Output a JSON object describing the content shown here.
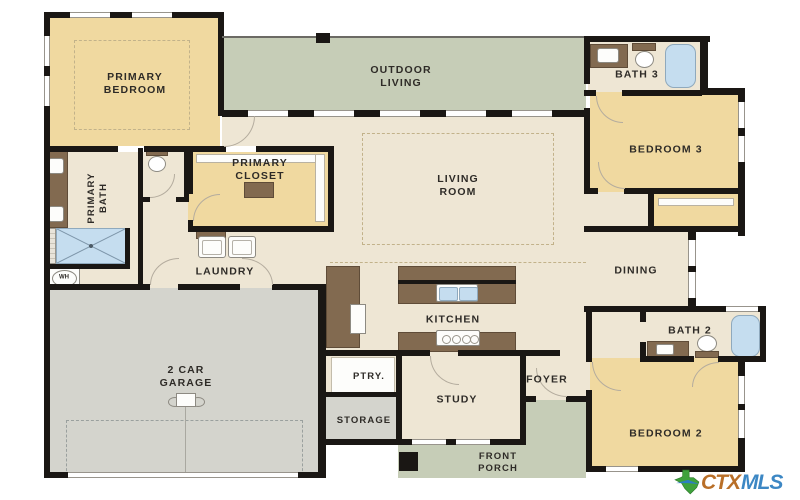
{
  "floor_plan": {
    "rooms": {
      "primary_bedroom": "PRIMARY BEDROOM",
      "outdoor_living": "OUTDOOR LIVING",
      "bath_3": "BATH 3",
      "bedroom_3": "BEDROOM 3",
      "primary_bath": "PRIMARY BATH",
      "primary_closet": "PRIMARY CLOSET",
      "living_room": "LIVING ROOM",
      "laundry": "LAUNDRY",
      "dining": "DINING",
      "garage": "2 CAR GARAGE",
      "kitchen": "KITCHEN",
      "pantry": "PTRY.",
      "storage": "STORAGE",
      "study": "STUDY",
      "foyer": "FOYER",
      "bath_2": "BATH 2",
      "bedroom_2": "BEDROOM 2",
      "front_porch": "FRONT PORCH"
    },
    "fixtures": {
      "water_heater": "WH"
    },
    "branding": {
      "mark": "CTX",
      "suffix": "MLS"
    },
    "colors": {
      "floor_beige": "#EEE6D4",
      "bedroom_yellow": "#F0D9A0",
      "outdoor_green": "#C6CDB7",
      "garage_gray": "#D4D4CD",
      "wall_black": "#1A1714",
      "cabinet_brown": "#826A50",
      "fixture_blue": "#C5DDEF",
      "logo_orange": "#B96F28",
      "logo_blue": "#3C87C4",
      "logo_green": "#3FA23C"
    }
  }
}
